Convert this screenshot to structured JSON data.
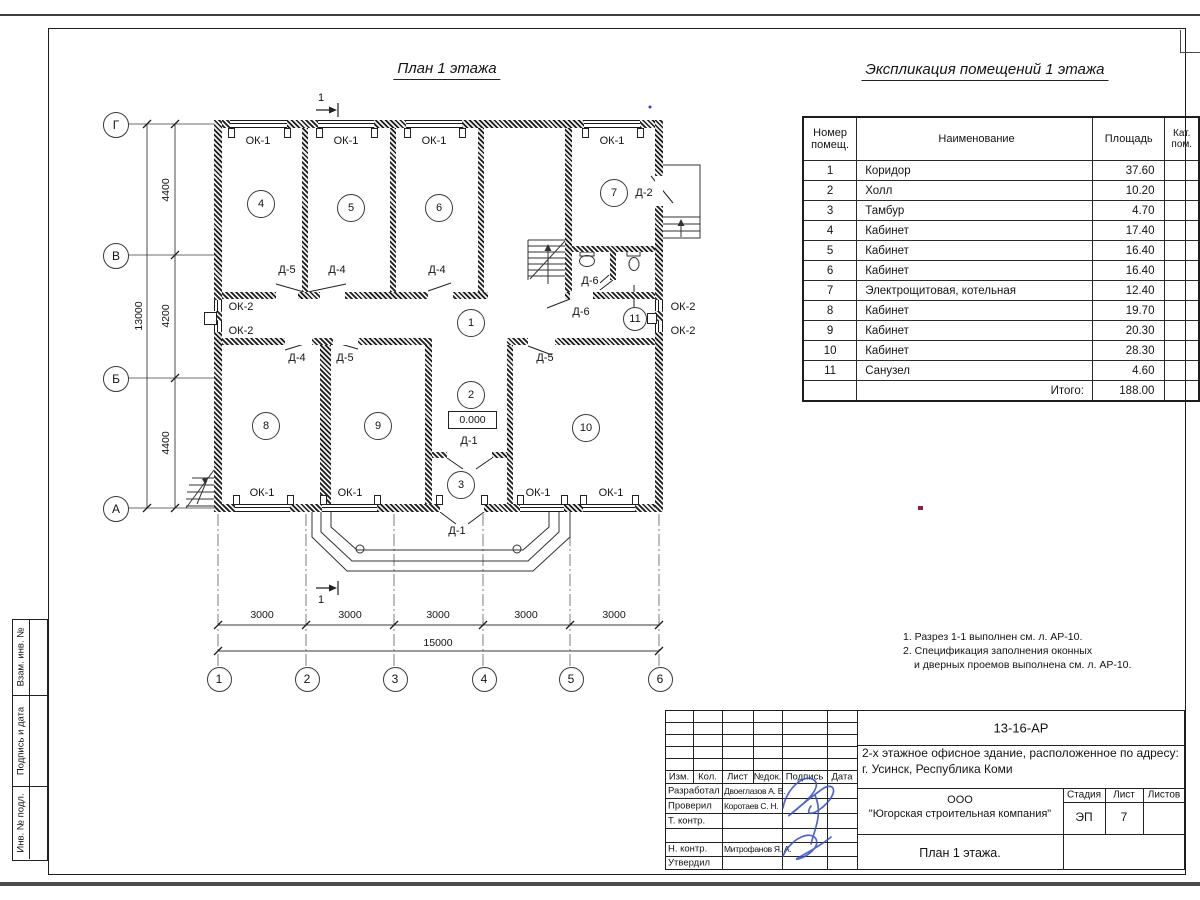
{
  "sheet": {
    "plan_title": "План 1 этажа",
    "expl_title": "Экспликация помещений 1 этажа",
    "notes": [
      "1. Разрез 1-1 выполнен см. л. АР-10.",
      "2. Спецификация заполнения оконных",
      "и дверных проемов выполнена см. л. АР-10."
    ],
    "sidebar": [
      "Взам. инв. №",
      "Подпись и дата",
      "Инв. № подл."
    ]
  },
  "table": {
    "headers": [
      "Номер помещ.",
      "Наименование",
      "Площадь",
      "Кат. пом."
    ],
    "rows": [
      [
        "1",
        "Коридор",
        "37.60"
      ],
      [
        "2",
        "Холл",
        "10.20"
      ],
      [
        "3",
        "Тамбур",
        "4.70"
      ],
      [
        "4",
        "Кабинет",
        "17.40"
      ],
      [
        "5",
        "Кабинет",
        "16.40"
      ],
      [
        "6",
        "Кабинет",
        "16.40"
      ],
      [
        "7",
        "Электрощитовая, котельная",
        "12.40"
      ],
      [
        "8",
        "Кабинет",
        "19.70"
      ],
      [
        "9",
        "Кабинет",
        "20.30"
      ],
      [
        "10",
        "Кабинет",
        "28.30"
      ],
      [
        "11",
        "Санузел",
        "4.60"
      ]
    ],
    "total_label": "Итого:",
    "total": "188.00"
  },
  "plan": {
    "elevation": "0.000",
    "rooms": [
      {
        "n": "4",
        "x": 260,
        "y": 203,
        "r": 13
      },
      {
        "n": "5",
        "x": 350,
        "y": 207,
        "r": 13
      },
      {
        "n": "6",
        "x": 438,
        "y": 207,
        "r": 13
      },
      {
        "n": "7",
        "x": 613,
        "y": 192,
        "r": 13
      },
      {
        "n": "1",
        "x": 470,
        "y": 322,
        "r": 13
      },
      {
        "n": "2",
        "x": 470,
        "y": 394,
        "r": 13
      },
      {
        "n": "3",
        "x": 460,
        "y": 484,
        "r": 13
      },
      {
        "n": "8",
        "x": 265,
        "y": 425,
        "r": 13
      },
      {
        "n": "9",
        "x": 377,
        "y": 425,
        "r": 13
      },
      {
        "n": "10",
        "x": 585,
        "y": 427,
        "r": 13
      },
      {
        "n": "11",
        "x": 634,
        "y": 318,
        "r": 11
      }
    ],
    "labels": [
      {
        "t": "ОК-1",
        "x": 258,
        "y": 141
      },
      {
        "t": "ОК-1",
        "x": 346,
        "y": 141
      },
      {
        "t": "ОК-1",
        "x": 434,
        "y": 141
      },
      {
        "t": "ОК-1",
        "x": 612,
        "y": 141
      },
      {
        "t": "ОК-1",
        "x": 262,
        "y": 493
      },
      {
        "t": "ОК-1",
        "x": 350,
        "y": 493
      },
      {
        "t": "ОК-1",
        "x": 538,
        "y": 493
      },
      {
        "t": "ОК-1",
        "x": 611,
        "y": 493
      },
      {
        "t": "ОК-2",
        "x": 241,
        "y": 307
      },
      {
        "t": "ОК-2",
        "x": 241,
        "y": 331
      },
      {
        "t": "ОК-2",
        "x": 683,
        "y": 307
      },
      {
        "t": "ОК-2",
        "x": 683,
        "y": 331
      },
      {
        "t": "Д-5",
        "x": 287,
        "y": 270
      },
      {
        "t": "Д-4",
        "x": 337,
        "y": 270
      },
      {
        "t": "Д-4",
        "x": 437,
        "y": 270
      },
      {
        "t": "Д-2",
        "x": 644,
        "y": 193
      },
      {
        "t": "Д-6",
        "x": 590,
        "y": 281
      },
      {
        "t": "Д-6",
        "x": 581,
        "y": 312
      },
      {
        "t": "Д-4",
        "x": 297,
        "y": 358
      },
      {
        "t": "Д-5",
        "x": 345,
        "y": 358
      },
      {
        "t": "Д-5",
        "x": 545,
        "y": 358
      },
      {
        "t": "Д-1",
        "x": 469,
        "y": 441
      },
      {
        "t": "Д-1",
        "x": 457,
        "y": 531
      },
      {
        "t": "1",
        "x": 321,
        "y": 98
      },
      {
        "t": "1",
        "x": 321,
        "y": 600
      }
    ],
    "axis_rows": [
      {
        "t": "Г",
        "y": 124
      },
      {
        "t": "В",
        "y": 255
      },
      {
        "t": "Б",
        "y": 378
      },
      {
        "t": "А",
        "y": 508
      }
    ],
    "axis_cols": [
      {
        "t": "1",
        "x": 218
      },
      {
        "t": "2",
        "x": 306
      },
      {
        "t": "3",
        "x": 394
      },
      {
        "t": "4",
        "x": 483
      },
      {
        "t": "5",
        "x": 570
      },
      {
        "t": "6",
        "x": 659
      }
    ],
    "dims_v": [
      {
        "t": "4400",
        "x": 166,
        "y": 190
      },
      {
        "t": "4200",
        "x": 166,
        "y": 316
      },
      {
        "t": "4400",
        "x": 166,
        "y": 443
      },
      {
        "t": "13000",
        "x": 139,
        "y": 316
      }
    ],
    "dims_h": [
      {
        "t": "3000",
        "x": 262,
        "y": 615
      },
      {
        "t": "3000",
        "x": 350,
        "y": 615
      },
      {
        "t": "3000",
        "x": 438,
        "y": 615
      },
      {
        "t": "3000",
        "x": 526,
        "y": 615
      },
      {
        "t": "3000",
        "x": 614,
        "y": 615
      },
      {
        "t": "15000",
        "x": 438,
        "y": 643
      }
    ]
  },
  "titleblock": {
    "code": "13-16-АР",
    "address_line1": "2-х этажное офисное здание, расположенное по адресу:",
    "address_line2": "г. Усинск, Республика Коми",
    "org_line1": "ООО",
    "org_line2": "\"Югорская строительная компания\"",
    "stage_label": "Стадия",
    "sheet_label": "Лист",
    "sheets_label": "Листов",
    "stage": "ЭП",
    "sheet_num": "7",
    "sheets": "",
    "drawing_title": "План 1 этажа.",
    "header_cols": [
      "Изм.",
      "Кол.",
      "Лист",
      "№док.",
      "Подпись",
      "Дата"
    ],
    "roles": [
      {
        "role": "Разработал",
        "name": "Двоеглазов А. В."
      },
      {
        "role": "Проверил",
        "name": "Коротаев С. Н."
      },
      {
        "role": "Т. контр.",
        "name": ""
      },
      {
        "role": "",
        "name": ""
      },
      {
        "role": "Н. контр.",
        "name": "Митрофанов Я. А."
      },
      {
        "role": "Утвердил",
        "name": ""
      }
    ]
  },
  "colors": {
    "signature": "#3952c4",
    "red_mark": "#8e2038",
    "blue_dot": "#2a44bb"
  }
}
